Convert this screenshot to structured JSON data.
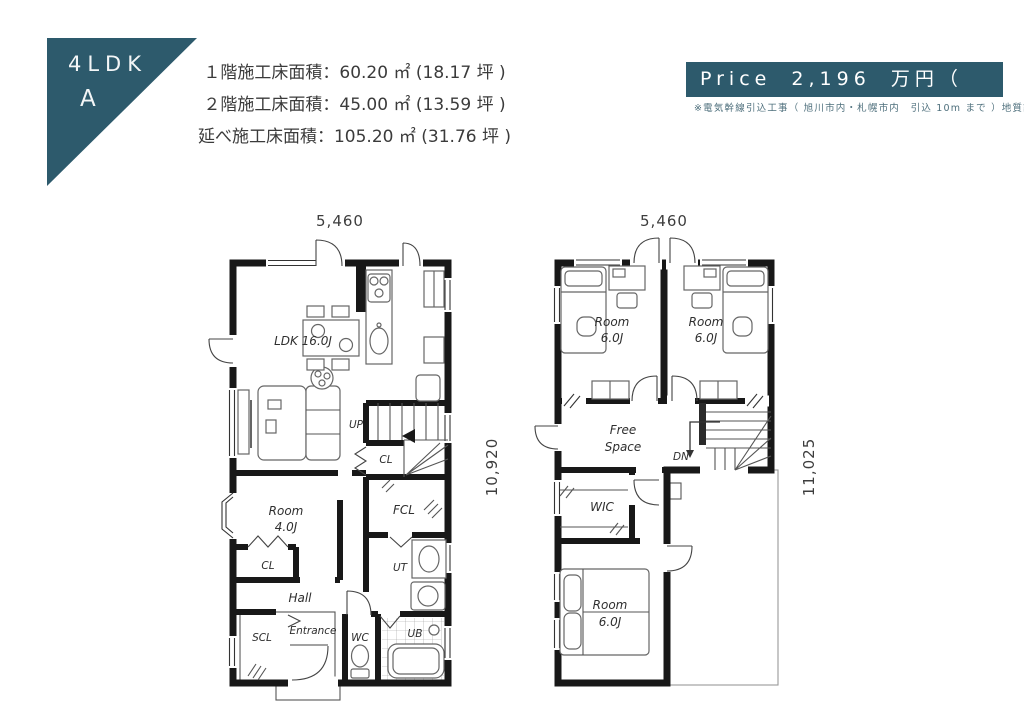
{
  "colors": {
    "teal": "#2d5a6c",
    "wall": "#181818",
    "note_text": "#4e6f7c"
  },
  "badge": {
    "type": "4LDK",
    "plan": "A"
  },
  "areas": [
    "１階施工床面積：60.20 ㎡ (18.17 坪 )",
    "２階施工床面積：45.00 ㎡ (13.59 坪 )",
    "延べ施工床面積：105.20 ㎡ (31.76 坪 )"
  ],
  "price": {
    "label": "Price 2,196 万円（",
    "note": "※電気幹線引込工事（ 旭川市内・札幌市内　引込 10m まで ）地質調査費含む"
  },
  "floor1": {
    "dim_width": "5,460",
    "dim_height": "10,920",
    "labels": {
      "ldk": "LDK 16.0J",
      "up": "UP",
      "stair_cl": "CL",
      "room_name": "Room",
      "room_size": "4.0J",
      "room_cl": "CL",
      "fcl": "FCL",
      "ut": "UT",
      "hall": "Hall",
      "scl": "SCL",
      "entrance": "Entrance",
      "wc": "WC",
      "ub": "UB"
    }
  },
  "floor2": {
    "dim_width": "5,460",
    "dim_height": "11,025",
    "labels": {
      "room1_name": "Room",
      "room1_size": "6.0J",
      "room2_name": "Room",
      "room2_size": "6.0J",
      "free_line1": "Free",
      "free_line2": "Space",
      "dn": "DN",
      "wic": "WIC",
      "room3_name": "Room",
      "room3_size": "6.0J"
    }
  }
}
